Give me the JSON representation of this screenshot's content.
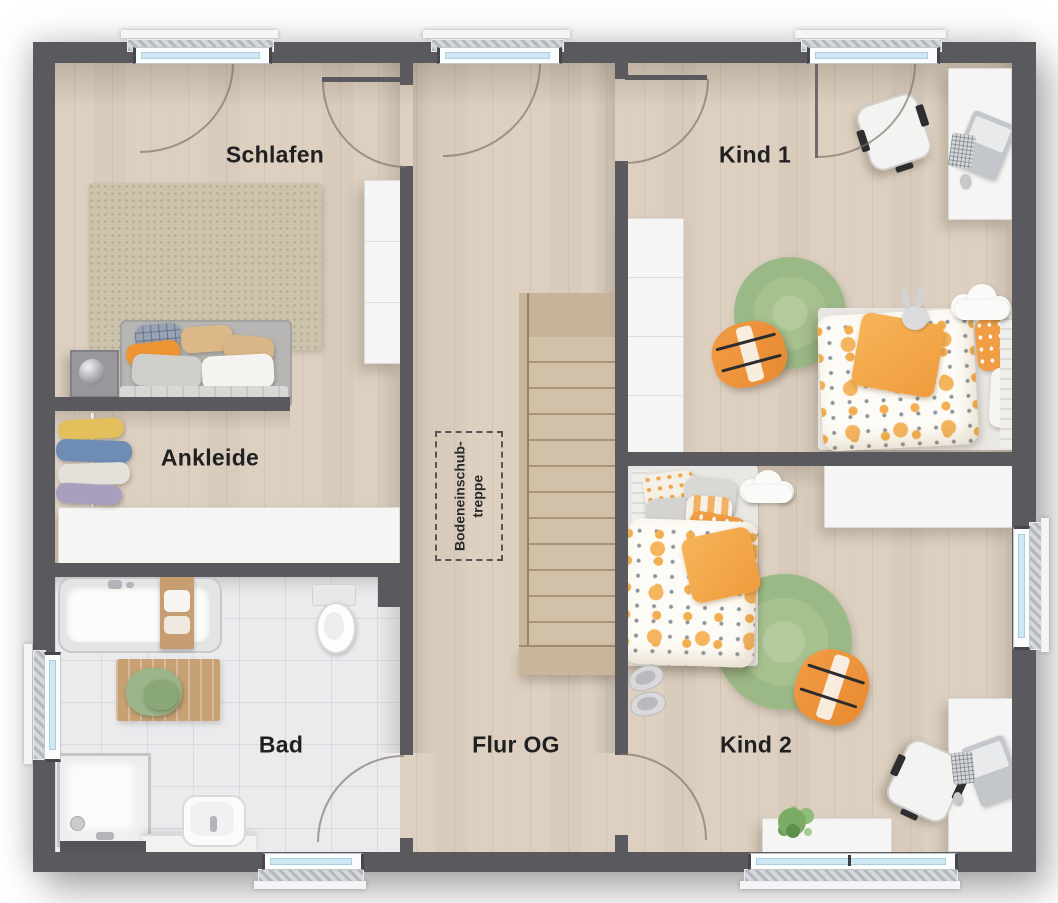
{
  "plan": {
    "type": "floorplan-upper-floor",
    "rooms": [
      {
        "id": "schlafen",
        "label": "Schlafen"
      },
      {
        "id": "kind1",
        "label": "Kind 1"
      },
      {
        "id": "ankleide",
        "label": "Ankleide"
      },
      {
        "id": "bad",
        "label": "Bad"
      },
      {
        "id": "flur",
        "label": "Flur OG"
      },
      {
        "id": "kind2",
        "label": "Kind 2"
      }
    ],
    "stair_note": {
      "line1": "Bodeneinschub-",
      "line2": "treppe"
    },
    "palette": {
      "wall": "#5a5a5e",
      "wood_floor": "#ddd0c1",
      "tile_floor": "#ebebee",
      "stair_wood": "#d2c1a9",
      "rug_green": "#a6c08e",
      "accent_orange": "#f09d44",
      "duvet_green": "#aecb9a",
      "window_glass": "#cfe7f3",
      "label_text": "#202022"
    }
  }
}
